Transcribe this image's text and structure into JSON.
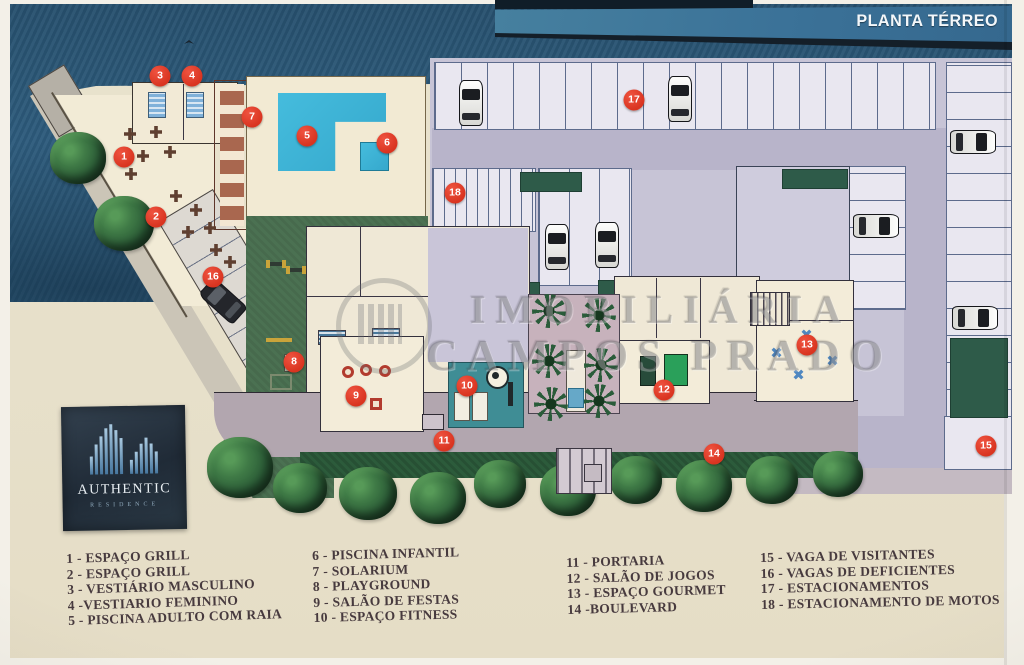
{
  "title": "PLANTA TÉRREO",
  "watermark": {
    "line1": "IMOBILIÁRIA",
    "line2": "CAMPOS PRADO"
  },
  "logo": {
    "name": "AUTHENTIC",
    "subtitle": "RESIDENCE"
  },
  "markers": [
    {
      "n": "1",
      "area": "Espaço Grill"
    },
    {
      "n": "2",
      "area": "Espaço Grill"
    },
    {
      "n": "3",
      "area": "Vestiário Masculino"
    },
    {
      "n": "4",
      "area": "Vestiário Feminino"
    },
    {
      "n": "5",
      "area": "Piscina Adulto com Raia"
    },
    {
      "n": "6",
      "area": "Piscina Infantil"
    },
    {
      "n": "7",
      "area": "Solarium"
    },
    {
      "n": "8",
      "area": "Playground"
    },
    {
      "n": "9",
      "area": "Salão de Festas"
    },
    {
      "n": "10",
      "area": "Espaço Fitness"
    },
    {
      "n": "11",
      "area": "Portaria"
    },
    {
      "n": "12",
      "area": "Salão de Jogos"
    },
    {
      "n": "13",
      "area": "Espaço Gourmet"
    },
    {
      "n": "14",
      "area": "Boulevard"
    },
    {
      "n": "15",
      "area": "Vaga de Visitantes"
    },
    {
      "n": "16",
      "area": "Vagas de Deficientes"
    },
    {
      "n": "17",
      "area": "Estacionamentos"
    },
    {
      "n": "18",
      "area": "Estacionamento de Motos"
    }
  ],
  "legend": {
    "columns": [
      {
        "items": [
          "1 - ESPAÇO GRILL",
          "2 - ESPAÇO GRILL",
          "3 - VESTIÁRIO MASCULINO",
          "4 -VESTIARIO FEMININO",
          "5 - PISCINA ADULTO COM RAIA"
        ]
      },
      {
        "items": [
          "6 - PISCINA INFANTIL",
          "7 - SOLARIUM",
          "8 - PLAYGROUND",
          "9 - SALÃO DE FESTAS",
          "10 - ESPAÇO FITNESS"
        ]
      },
      {
        "items": [
          "11 - PORTARIA",
          "12 - SALÃO DE JOGOS",
          "13 - ESPAÇO GOURMET",
          "14 -BOULEVARD"
        ]
      },
      {
        "items": [
          "15 - VAGA DE VISITANTES",
          "16 - VAGAS DE DEFICIENTES",
          "17 - ESTACIONAMENTOS",
          "18 - ESTACIONAMENTO DE MOTOS"
        ]
      }
    ]
  },
  "colors": {
    "marker_red": "#e2422c",
    "pool_blue": "#3cb3d6",
    "header_blue": "#3b7298",
    "lawn_green": "#4b7152",
    "hedge_green": "#2e5b49",
    "parking_lavender": "#c7c4d6",
    "deck_cream": "#f1e9d3",
    "sand_beige": "#e8e1cc",
    "logo_navy": "#243240"
  }
}
